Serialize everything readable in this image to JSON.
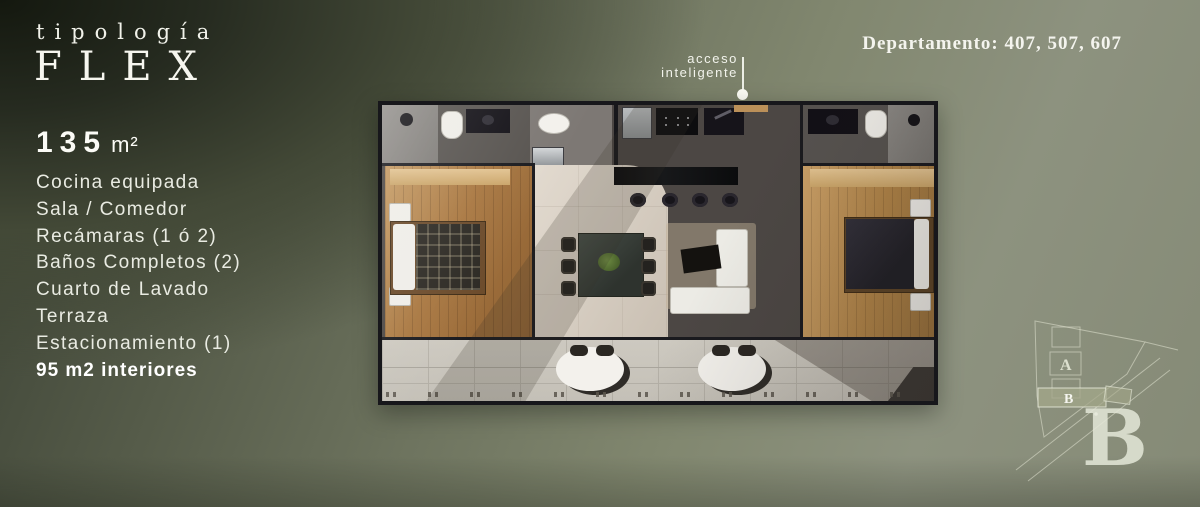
{
  "brand": {
    "kicker": "tipología",
    "name": "FLEX"
  },
  "header": {
    "departments": "Departamento: 407, 507, 607"
  },
  "specs": {
    "area_value": "135",
    "area_unit": "m²",
    "features": [
      "Cocina equipada",
      "Sala / Comedor",
      "Recámaras (1 ó 2)",
      "Baños Completos (2)",
      "Cuarto de Lavado",
      "Terraza",
      "Estacionamiento (1)"
    ],
    "highlight": "95 m2 interiores"
  },
  "floorplan": {
    "annotation_line1": "acceso",
    "annotation_line2": "inteligente"
  },
  "siteplan": {
    "building_a_label": "A",
    "building_b_label": "B",
    "tower_letter": "B"
  },
  "colors": {
    "background_dark": "#20241e",
    "background_sage": "#8d927f",
    "text": "#edeee7",
    "wood_floor": "#a8763f",
    "kitchen_floor": "#4c4744",
    "living_floor": "#d5ccc0",
    "terrace_floor": "#c8c4bb",
    "wall": "#17171b"
  }
}
